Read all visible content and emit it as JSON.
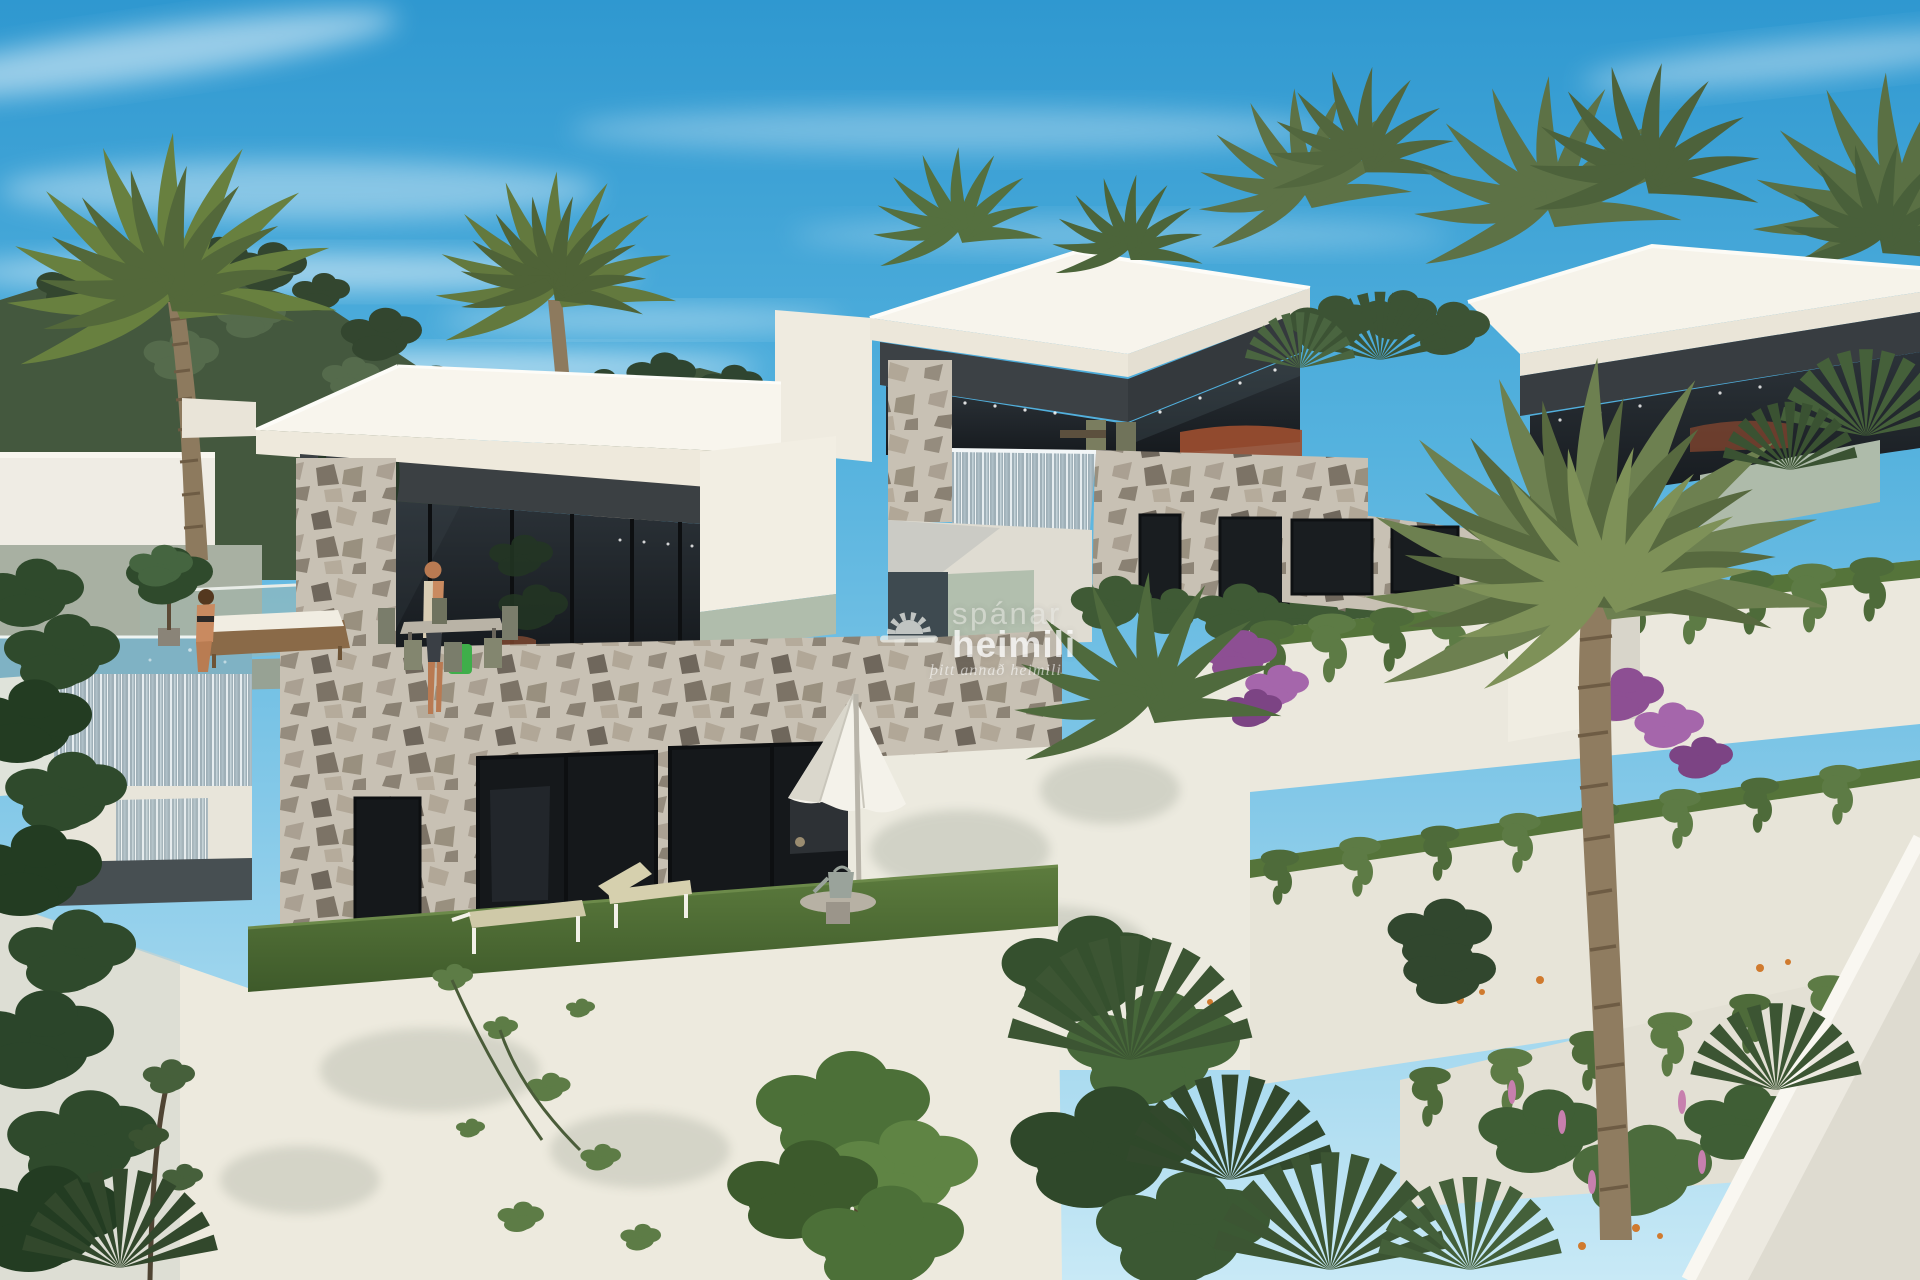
{
  "scene": {
    "description": "3D architectural rendering of three modern flat-roof villas on a terraced hillside with an infinity pool, stone cladding, lush gardens and palm trees under a blue sky"
  },
  "watermark": {
    "brand_top": "spánar",
    "brand_bottom": "heimili",
    "tagline": "þitt annað heimili",
    "logo_icon": "sun-over-horizon"
  },
  "palette": {
    "sky_top": "#2f98d0",
    "sky_horizon": "#c8e9f6",
    "cloud": "#ffffff",
    "villa_white": "#f6f3ea",
    "fascia_shade": "#ece7da",
    "soffit_dark": "#3b4043",
    "glass_dark": "#1d2327",
    "frosted_sage_glass": "#b0bdac",
    "stone_cladding": "#c8c1b4",
    "hill_forest": "#44583e",
    "foliage": "#5d7b45",
    "grass": "#4d6c33",
    "pool_water": "#7fb2c4",
    "waterfall": "#aebfc7",
    "wood": "#8a6a48",
    "sofa_accent": "#8f4a2e",
    "bag_accent": "#3fae4a",
    "bougainvillea": "#8d4f93",
    "flower_pink": "#c77fae",
    "flower_orange": "#d07a2e",
    "skin": "#c98a60"
  }
}
